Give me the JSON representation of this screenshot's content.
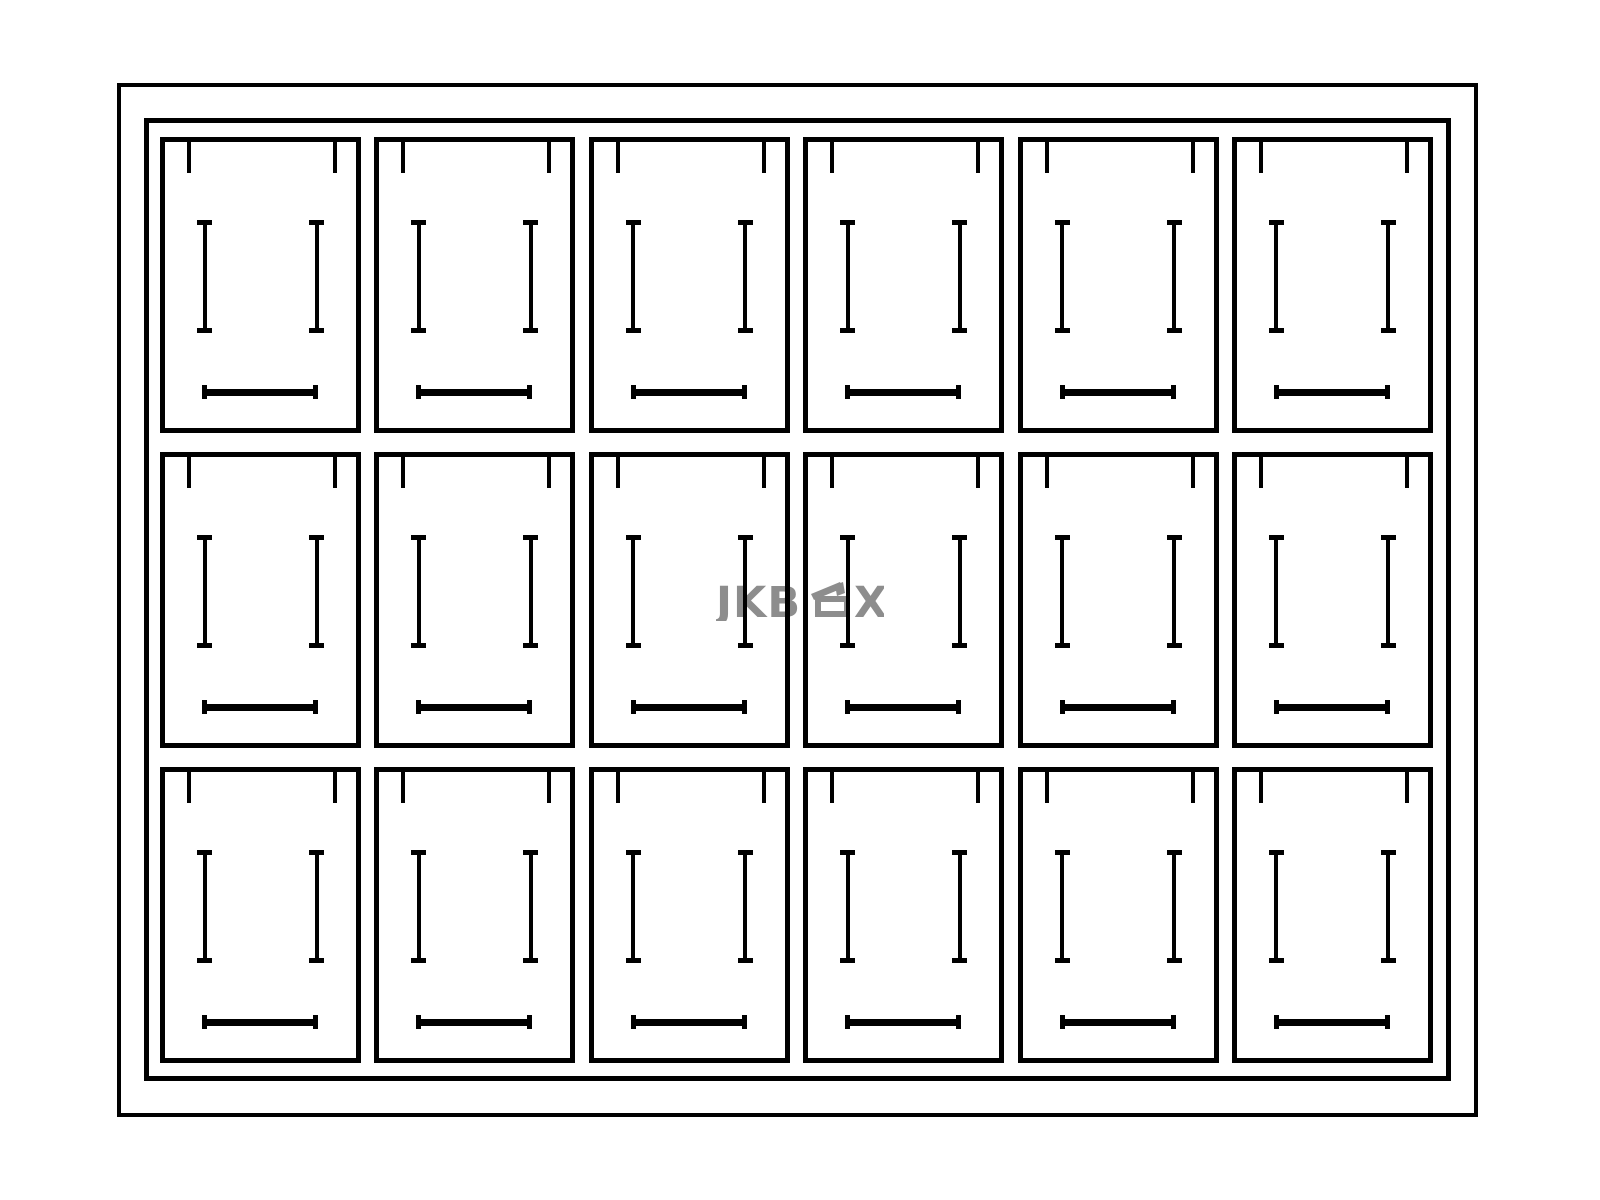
{
  "diagram": {
    "type": "tray-compartment-line-drawing",
    "rows": 3,
    "columns": 6,
    "compartment_count": 18,
    "background_color": "#ffffff",
    "line_color": "#000000",
    "compartment_marks": {
      "top_notches": 2,
      "vertical_pins": 2,
      "horizontal_bars": 1
    }
  },
  "watermark": {
    "full_text": "JKBOX",
    "text_left": "JKB",
    "text_right": "X",
    "box_icon": "open-lid-box-icon",
    "color": "#8d8d8d"
  }
}
